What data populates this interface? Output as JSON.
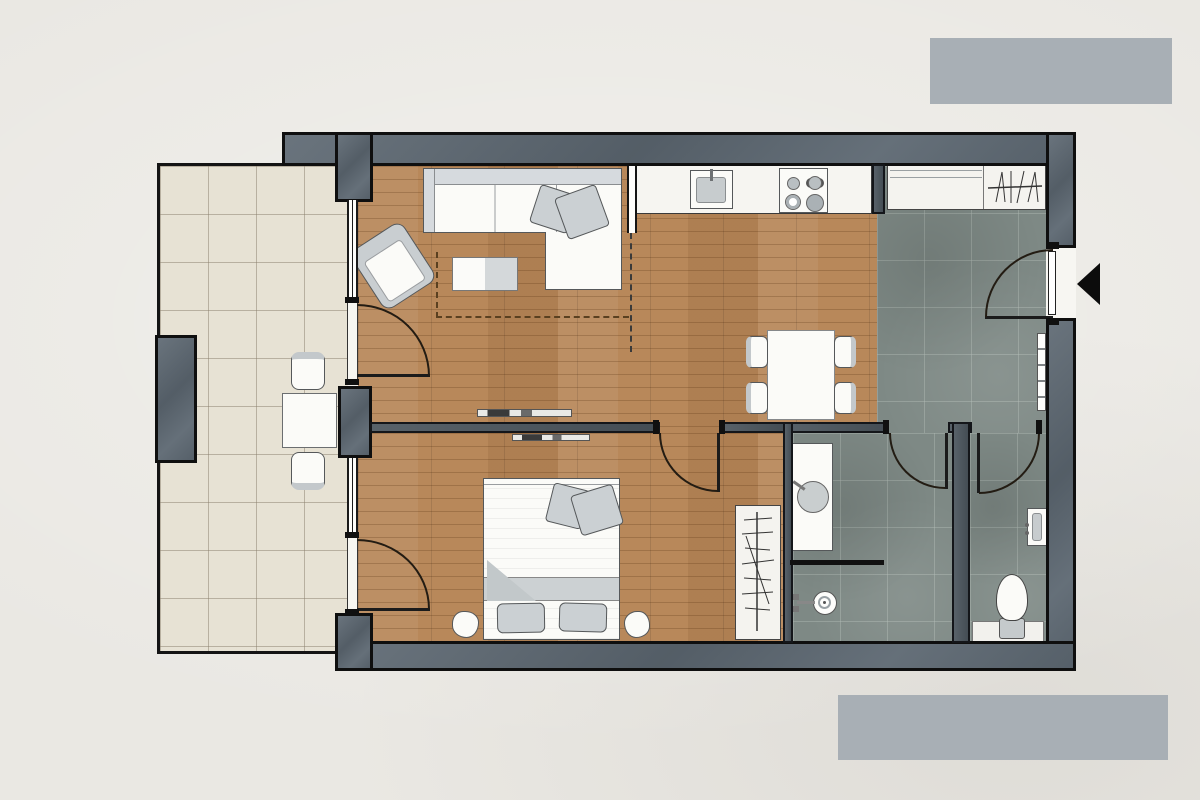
{
  "title": "apartment-floor-plan",
  "palette": {
    "bg": "#eae8e3",
    "logo_gray": "#a8afb5",
    "wall_fill": "#5d6872",
    "wall_line": "#0f0f0f",
    "iwall_fill": "#4e5860",
    "wood": "#b8885a",
    "tile_beige": "#e7e2d4",
    "tile_gray": "#7e8985",
    "furn_white": "#fbfbf8",
    "furn_gray": "#cbd0d3",
    "furn_line": "#55585a",
    "door_line": "#231c13",
    "dash_line": "#5a4020",
    "black": "#0c0c0c"
  },
  "rooms": [
    {
      "id": "balcony",
      "label": "Balcony",
      "floor": "beige ceramic tile"
    },
    {
      "id": "living-room",
      "label": "Living room",
      "floor": "wood parquet"
    },
    {
      "id": "kitchen",
      "label": "Kitchen",
      "floor": "wood parquet"
    },
    {
      "id": "dining-area",
      "label": "Dining area",
      "floor": "wood parquet"
    },
    {
      "id": "entry-hall",
      "label": "Entry hall",
      "floor": "gray stone tile"
    },
    {
      "id": "bedroom",
      "label": "Bedroom",
      "floor": "wood parquet"
    },
    {
      "id": "bathroom",
      "label": "Bathroom",
      "floor": "gray stone tile"
    },
    {
      "id": "wc",
      "label": "WC",
      "floor": "gray stone tile"
    }
  ],
  "furniture": {
    "balcony": [
      "bistro table",
      "chair north",
      "chair south"
    ],
    "living_room": [
      "sofa with chaise",
      "two throw cushions",
      "armchair rotated",
      "two-tone coffee table",
      "dashed rug outline",
      "wall console"
    ],
    "kitchen": [
      "counter run",
      "single-basin sink with faucet",
      "cooktop with four burners",
      "dashed zone divider"
    ],
    "dining_area": [
      "rectangular table",
      "four chairs"
    ],
    "entry_hall": [
      "built-in wardrobe with shelf and hanging rail",
      "radiator",
      "entry door",
      "entrance arrow marker"
    ],
    "bedroom": [
      "double bed",
      "two pillows",
      "two throw cushions",
      "folded blanket",
      "two bedside poufs",
      "wardrobe with hanging rail",
      "wall console"
    ],
    "bathroom": [
      "vanity with round basin",
      "shower half-wall",
      "floor shower with mixer"
    ],
    "wc": [
      "toilet with cistern",
      "wall ledge",
      "small washbasin"
    ]
  },
  "doors": [
    {
      "id": "entry-door",
      "location": "right exterior wall",
      "swing": "inward"
    },
    {
      "id": "living-balcony-door",
      "location": "living room west glazing",
      "swing": "inward"
    },
    {
      "id": "bedroom-balcony-door",
      "location": "bedroom west glazing",
      "swing": "inward"
    },
    {
      "id": "bedroom-door",
      "location": "living/bedroom wall",
      "swing": "into bedroom"
    },
    {
      "id": "bathroom-door",
      "location": "hall/bathroom wall",
      "swing": "into bathroom"
    },
    {
      "id": "wc-door",
      "location": "hall/wc wall",
      "swing": "into wc"
    }
  ],
  "annotations": {
    "entrance_marker": "solid black triangle pointing left at entry door",
    "logo_top": "redacted gray rectangle",
    "logo_bottom": "redacted gray rectangle"
  }
}
